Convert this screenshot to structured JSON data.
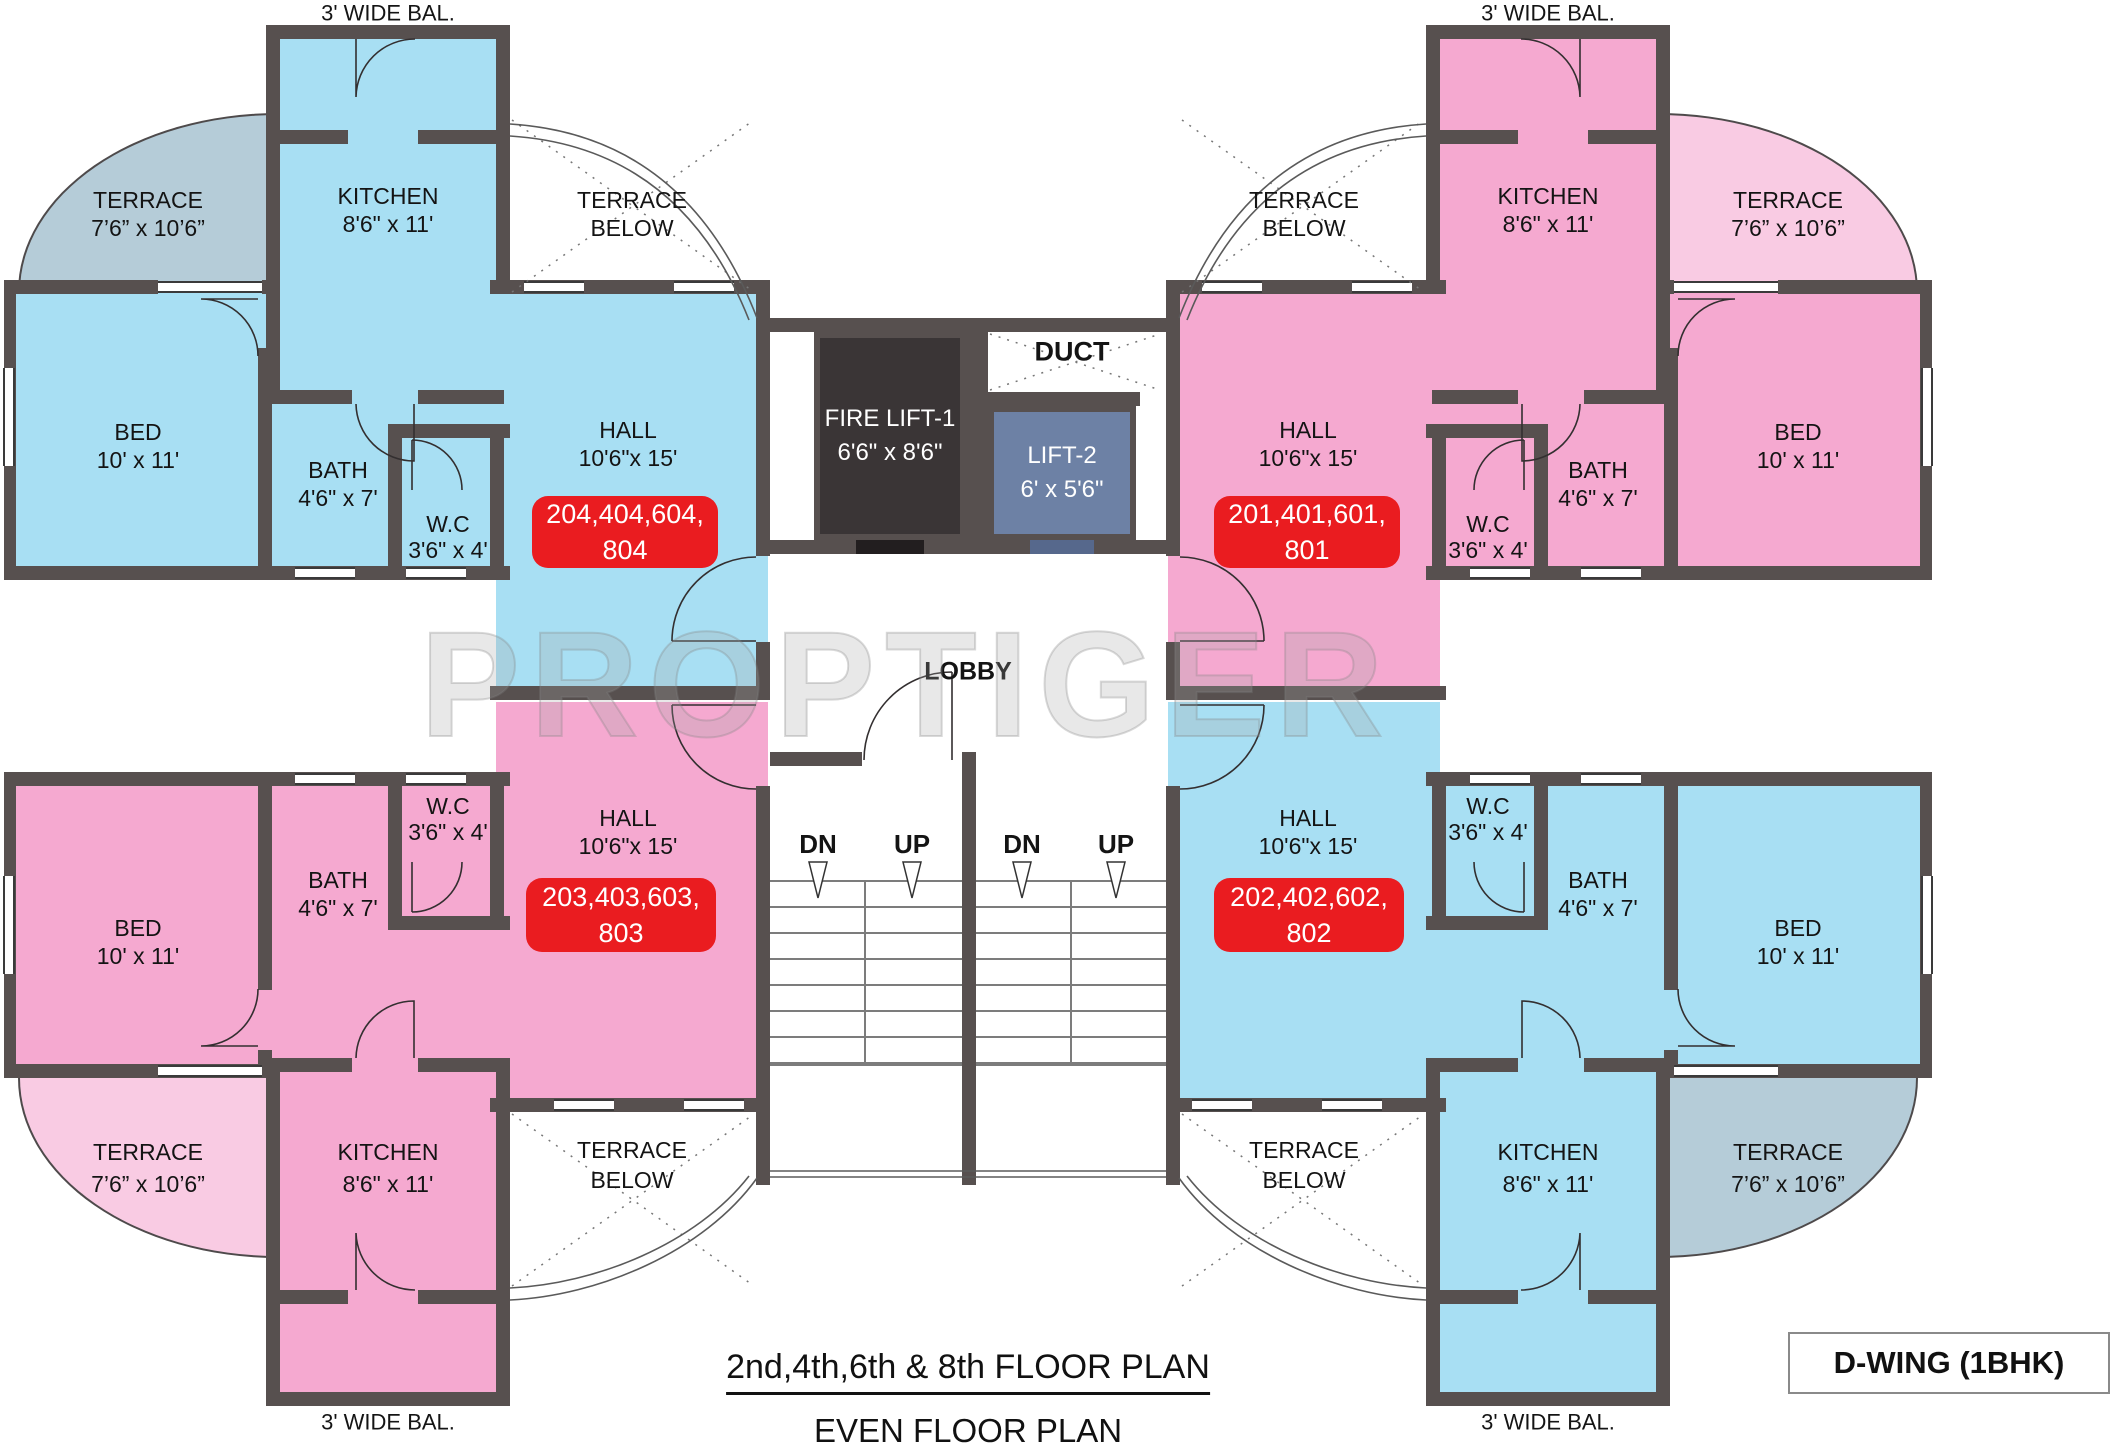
{
  "watermark": "PROPTIGER",
  "captions": {
    "floor_plan": "2nd,4th,6th & 8th FLOOR PLAN",
    "even_plan": "EVEN FLOOR PLAN"
  },
  "wing_label": "D-WING (1BHK)",
  "core": {
    "fire_lift": {
      "name": "FIRE LIFT-1",
      "dim": "6'6\" x 8'6\""
    },
    "lift2": {
      "name": "LIFT-2",
      "dim": "6' x 5'6\""
    },
    "duct_label": "DUCT",
    "lobby_label": "LOBBY",
    "stairs": {
      "dn1": "DN",
      "up1": "UP",
      "dn2": "DN",
      "up2": "UP"
    }
  },
  "colors": {
    "wall": "#57504f",
    "unit_blue": "#a8dff3",
    "unit_pink": "#f5a9d0",
    "terrace_gray_blue": "#b5ccd8",
    "terrace_light_pink": "#f9cbe3",
    "badge_red": "#ea1c20",
    "fire_lift_dark": "#3a3536",
    "lift2_slate": "#6d81a5"
  },
  "units": [
    {
      "id": "204",
      "position": "top-left",
      "fill_color": "#a8dff3",
      "terrace_color": "#b5ccd8",
      "badge": {
        "line1": "204,404,604,",
        "line2": "804"
      },
      "rooms": {
        "balcony": "3' WIDE BAL.",
        "kitchen": {
          "name": "KITCHEN",
          "dim": "8'6\" x 11'"
        },
        "terrace": {
          "name": "TERRACE",
          "dim": "7’6” x 10’6”"
        },
        "terrace_below": {
          "line1": "TERRACE",
          "line2": "BELOW"
        },
        "bed": {
          "name": "BED",
          "dim": "10' x 11'"
        },
        "bath": {
          "name": "BATH",
          "dim": "4'6\" x 7'"
        },
        "wc": {
          "name": "W.C",
          "dim": "3'6\" x 4'"
        },
        "hall": {
          "name": "HALL",
          "dim": "10'6\"x 15'"
        }
      }
    },
    {
      "id": "201",
      "position": "top-right",
      "fill_color": "#f5a9d0",
      "terrace_color": "#f9cbe3",
      "badge": {
        "line1": "201,401,601,",
        "line2": "801"
      },
      "rooms": {
        "balcony": "3' WIDE BAL.",
        "kitchen": {
          "name": "KITCHEN",
          "dim": "8'6\" x 11'"
        },
        "terrace": {
          "name": "TERRACE",
          "dim": "7’6” x 10’6”"
        },
        "terrace_below": {
          "line1": "TERRACE",
          "line2": "BELOW"
        },
        "bed": {
          "name": "BED",
          "dim": "10' x 11'"
        },
        "bath": {
          "name": "BATH",
          "dim": "4'6\" x 7'"
        },
        "wc": {
          "name": "W.C",
          "dim": "3'6\" x 4'"
        },
        "hall": {
          "name": "HALL",
          "dim": "10'6\"x 15'"
        }
      }
    },
    {
      "id": "203",
      "position": "bottom-left",
      "fill_color": "#f5a9d0",
      "terrace_color": "#f9cbe3",
      "badge": {
        "line1": "203,403,603,",
        "line2": "803"
      },
      "rooms": {
        "balcony": "3' WIDE BAL.",
        "kitchen": {
          "name": "KITCHEN",
          "dim": "8'6\" x 11'"
        },
        "terrace": {
          "name": "TERRACE",
          "dim": "7’6” x 10’6”"
        },
        "terrace_below": {
          "line1": "TERRACE",
          "line2": "BELOW"
        },
        "bed": {
          "name": "BED",
          "dim": "10' x 11'"
        },
        "bath": {
          "name": "BATH",
          "dim": "4'6\" x 7'"
        },
        "wc": {
          "name": "W.C",
          "dim": "3'6\" x 4'"
        },
        "hall": {
          "name": "HALL",
          "dim": "10'6\"x 15'"
        }
      }
    },
    {
      "id": "202",
      "position": "bottom-right",
      "fill_color": "#a8dff3",
      "terrace_color": "#b5ccd8",
      "badge": {
        "line1": "202,402,602,",
        "line2": "802"
      },
      "rooms": {
        "balcony": "3' WIDE BAL.",
        "kitchen": {
          "name": "KITCHEN",
          "dim": "8'6\" x 11'"
        },
        "terrace": {
          "name": "TERRACE",
          "dim": "7’6” x 10’6”"
        },
        "terrace_below": {
          "line1": "TERRACE",
          "line2": "BELOW"
        },
        "bed": {
          "name": "BED",
          "dim": "10' x 11'"
        },
        "bath": {
          "name": "BATH",
          "dim": "4'6\" x 7'"
        },
        "wc": {
          "name": "W.C",
          "dim": "3'6\" x 4'"
        },
        "hall": {
          "name": "HALL",
          "dim": "10'6\"x 15'"
        }
      }
    }
  ]
}
